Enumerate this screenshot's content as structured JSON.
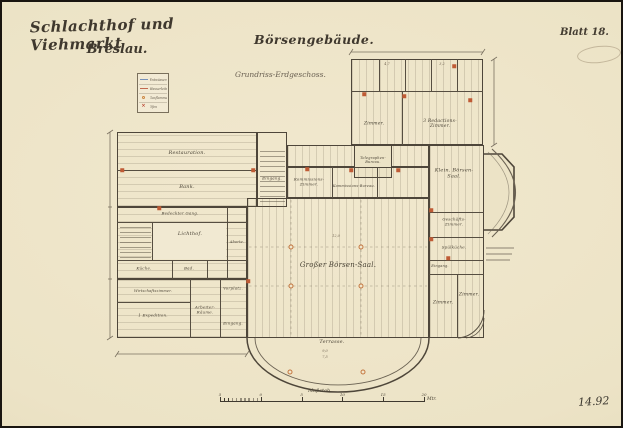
{
  "sheet": {
    "title_line1": "Schlachthof und Viehmarkt",
    "title_line2": "Breslau.",
    "building_title": "Börsengebäude.",
    "plan_caption": "Grundriss-Erdgeschoss.",
    "sheet_no": "Blatt 18.",
    "inventory_no": "14.92"
  },
  "legend": {
    "items": [
      {
        "name": "drainage-line",
        "type": "line",
        "color": "#7791b8",
        "label": "Entwässerung"
      },
      {
        "name": "water-pipe-line",
        "type": "line",
        "color": "#c26a50",
        "label": "Wasserleitung"
      },
      {
        "name": "gas-flame-mark",
        "type": "circle",
        "color": "#cd8844",
        "label": "Gasflammen"
      },
      {
        "name": "stove-mark",
        "type": "cross",
        "color": "#bb4733",
        "label": "Öfen"
      }
    ]
  },
  "scalebar": {
    "label": "Maßstab",
    "unit": "Mtr.",
    "ticks": [
      "5",
      "0",
      "5",
      "10",
      "15",
      "20"
    ]
  },
  "plan": {
    "rooms": [
      {
        "label": "Restauration.",
        "x": 185,
        "y": 152,
        "fs": 5
      },
      {
        "label": "Bank.",
        "x": 185,
        "y": 186,
        "fs": 5
      },
      {
        "label": "Eingang.",
        "x": 270,
        "y": 177,
        "fs": 4
      },
      {
        "label": "Bedeckter Gang.",
        "x": 178,
        "y": 212,
        "fs": 4
      },
      {
        "label": "Lichthof.",
        "x": 188,
        "y": 233,
        "fs": 5
      },
      {
        "label": "Aborte.",
        "x": 235,
        "y": 240,
        "fs": 3.5
      },
      {
        "label": "Küche.",
        "x": 142,
        "y": 267,
        "fs": 4
      },
      {
        "label": "Bad.",
        "x": 187,
        "y": 267,
        "fs": 4
      },
      {
        "label": "Wirtschaftszimmer.",
        "x": 151,
        "y": 289,
        "fs": 3.5
      },
      {
        "label": "1 Expedition.",
        "x": 151,
        "y": 314,
        "fs": 4
      },
      {
        "label": "Arbeiter-\nRäume.",
        "x": 203,
        "y": 308,
        "fs": 4
      },
      {
        "label": "Vorplatz.",
        "x": 231,
        "y": 287,
        "fs": 4
      },
      {
        "label": "Eingang.",
        "x": 231,
        "y": 322,
        "fs": 4
      },
      {
        "label": "Kommissions-\nZimmer.",
        "x": 307,
        "y": 180,
        "fs": 4
      },
      {
        "label": "Kommissions-Bureau.",
        "x": 352,
        "y": 184,
        "fs": 3.5
      },
      {
        "label": "Telegraphen-\nBureau.",
        "x": 371,
        "y": 158,
        "fs": 3.5
      },
      {
        "label": "Zimmer.",
        "x": 372,
        "y": 122,
        "fs": 4.5
      },
      {
        "label": "3 Redactions-\nZimmer.",
        "x": 438,
        "y": 122,
        "fs": 4.5
      },
      {
        "label": "Großer Börsen-Saal.",
        "x": 336,
        "y": 263,
        "fs": 7
      },
      {
        "label": "Klein. Börsen-\nSaal.",
        "x": 452,
        "y": 172,
        "fs": 5
      },
      {
        "label": "Geschäfts-\nZimmer.",
        "x": 452,
        "y": 220,
        "fs": 4
      },
      {
        "label": "Spülküche.",
        "x": 452,
        "y": 246,
        "fs": 4
      },
      {
        "label": "Eingang.",
        "x": 438,
        "y": 264,
        "fs": 3.5
      },
      {
        "label": "Zimmer.",
        "x": 441,
        "y": 301,
        "fs": 4.5
      },
      {
        "label": "Zimmer.",
        "x": 467,
        "y": 293,
        "fs": 4.5
      },
      {
        "label": "Terrasse.",
        "x": 330,
        "y": 341,
        "fs": 5
      }
    ],
    "columns": [
      {
        "x": 289,
        "y": 245
      },
      {
        "x": 359,
        "y": 245
      },
      {
        "x": 289,
        "y": 284
      },
      {
        "x": 359,
        "y": 284
      },
      {
        "x": 288,
        "y": 370
      },
      {
        "x": 361,
        "y": 370
      }
    ],
    "stoves": [
      {
        "x": 251,
        "y": 168
      },
      {
        "x": 305,
        "y": 167
      },
      {
        "x": 349,
        "y": 168
      },
      {
        "x": 396,
        "y": 168
      },
      {
        "x": 429,
        "y": 208
      },
      {
        "x": 429,
        "y": 237
      },
      {
        "x": 446,
        "y": 256
      },
      {
        "x": 362,
        "y": 92
      },
      {
        "x": 402,
        "y": 94
      },
      {
        "x": 452,
        "y": 64
      },
      {
        "x": 468,
        "y": 98
      },
      {
        "x": 157,
        "y": 206
      },
      {
        "x": 246,
        "y": 279
      },
      {
        "x": 120,
        "y": 168
      }
    ],
    "dims": [
      {
        "text": "12,0",
        "x": 334,
        "y": 234
      },
      {
        "text": "9,0",
        "x": 323,
        "y": 349
      },
      {
        "text": "7,5",
        "x": 323,
        "y": 355
      },
      {
        "text": "4,7",
        "x": 385,
        "y": 62
      },
      {
        "text": "3,2",
        "x": 440,
        "y": 62
      }
    ]
  }
}
